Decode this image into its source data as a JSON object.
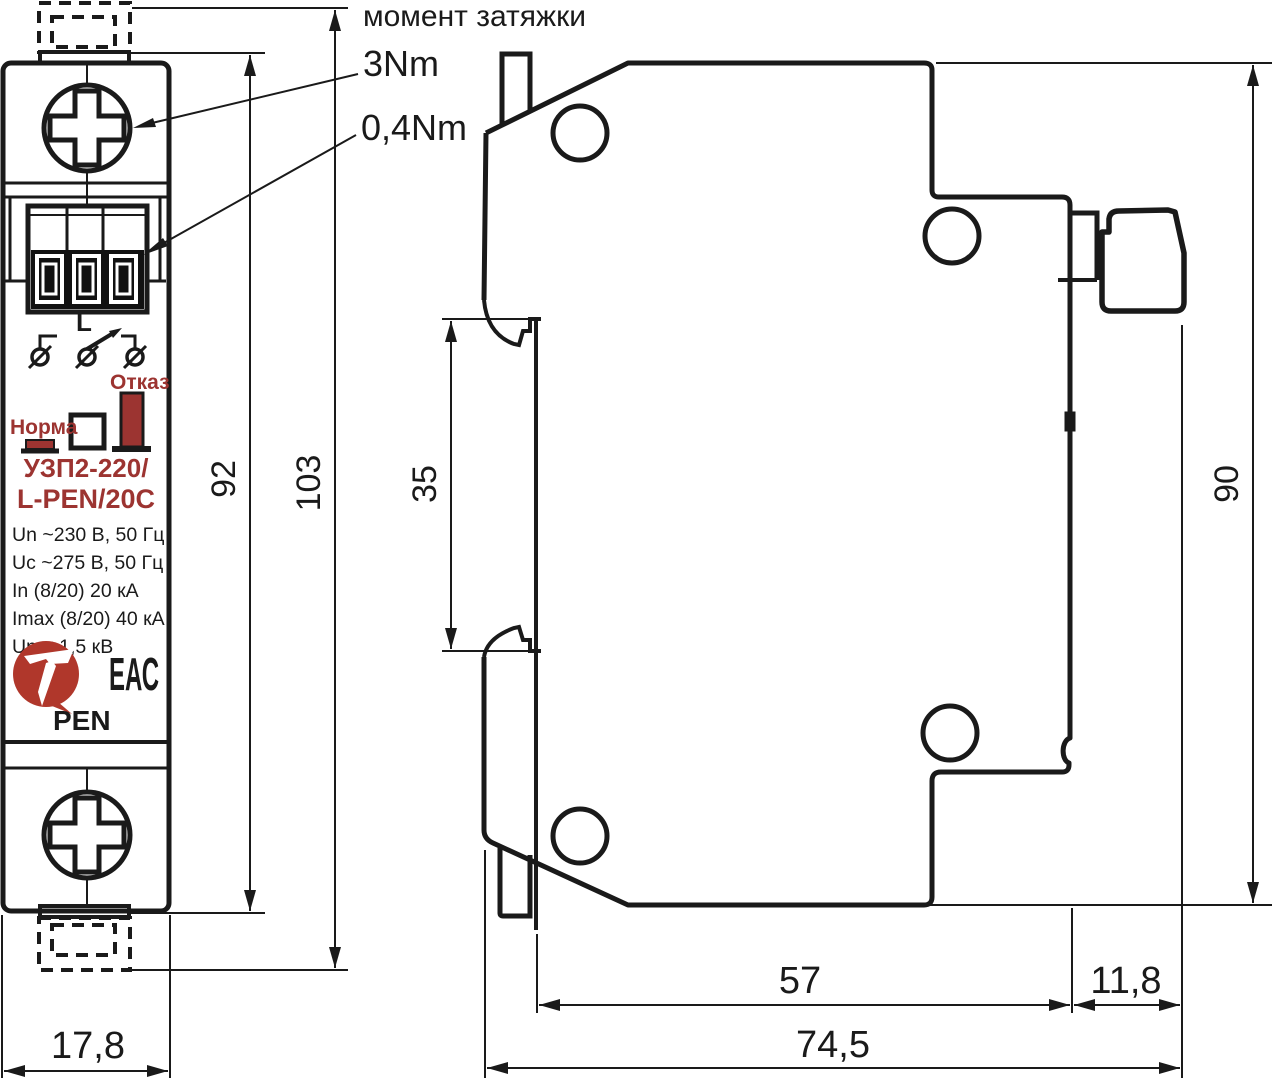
{
  "drawing": {
    "heading": "момент затяжки",
    "torque_screw": "3Nm",
    "torque_terminal": "0,4Nm"
  },
  "device": {
    "phase_mark": "L",
    "status_fail_label": "Отказ",
    "status_ok_label": "Норма",
    "model_line1": "УЗП2-220/",
    "model_line2": "L-PEN/20C",
    "spec_lines": [
      "Un ~230 В, 50 Гц",
      "Uc ~275 В, 50 Гц",
      "In (8/20) 20 кА",
      "Imax (8/20) 40 кА",
      "Up  <  1,5 кВ"
    ],
    "eac_mark": "ЕАС",
    "bottom_mark": "PEN"
  },
  "dimensions_mm": {
    "front_width": "17,8",
    "front_body_height": "92",
    "front_total_height": "103",
    "rail_window": "35",
    "side_height": "90",
    "side_depth_body": "57",
    "side_depth_clip": "11,8",
    "side_depth_total": "74,5"
  },
  "colors": {
    "line": "#1a1a1a",
    "red": "#9c3431",
    "logo_red": "#b0372b",
    "white": "#ffffff"
  }
}
